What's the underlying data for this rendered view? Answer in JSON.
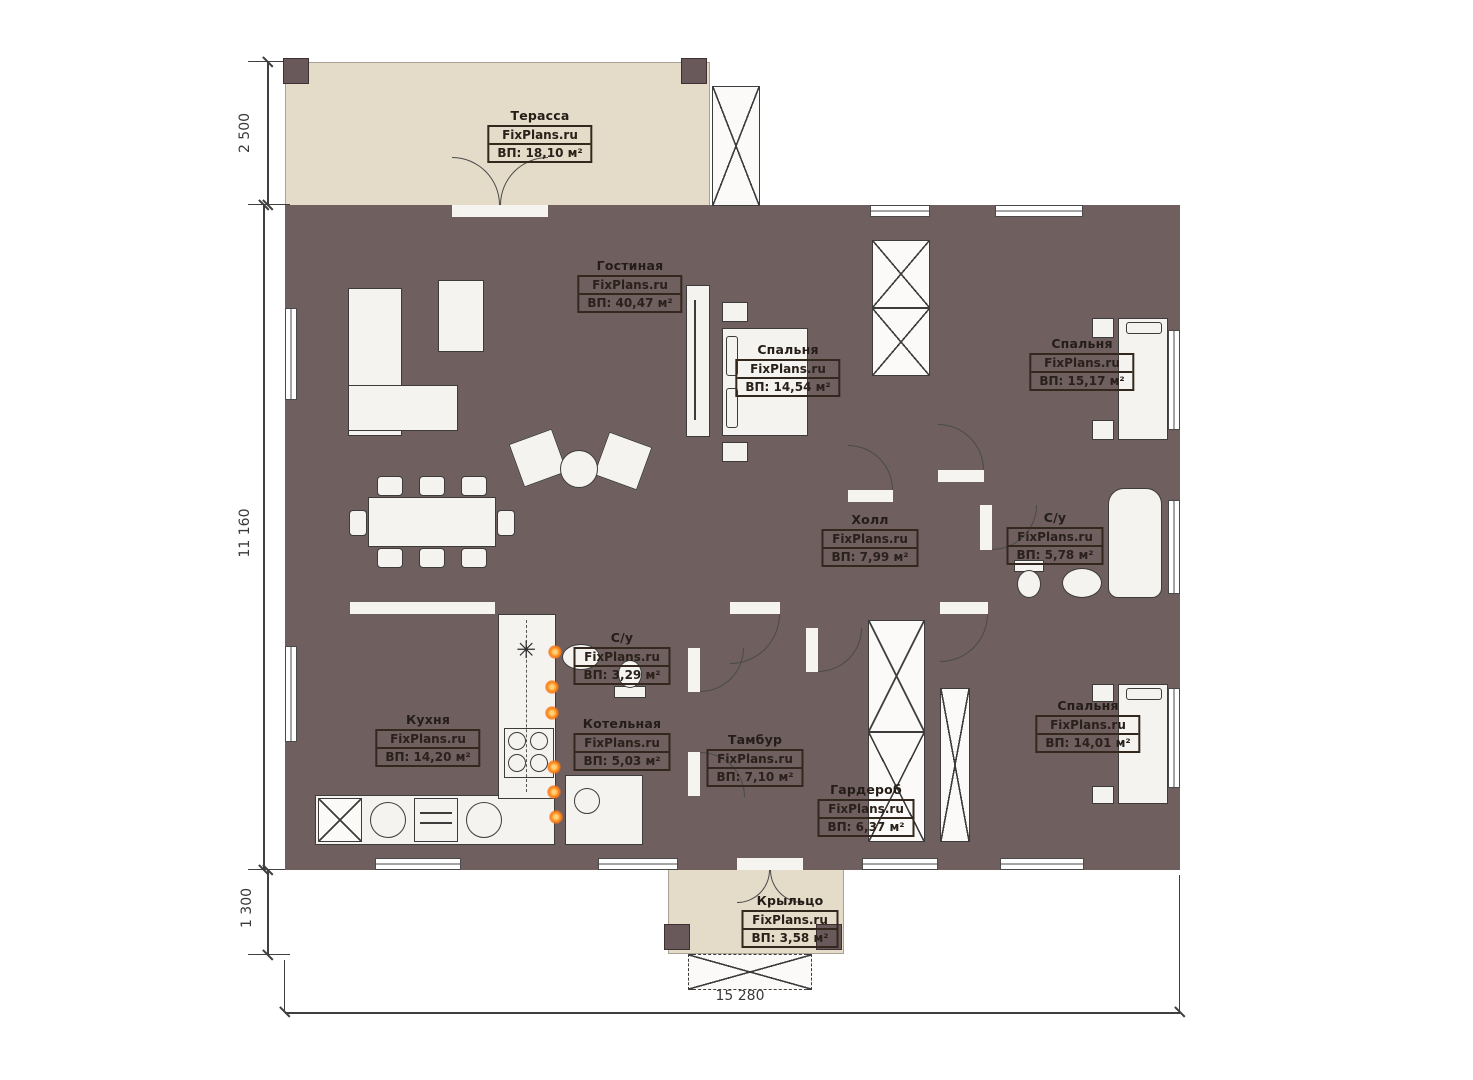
{
  "brand": "FixPlans.ru",
  "dimensions": {
    "terrace_depth": "2 500",
    "house_height": "11 160",
    "porch_depth": "1 300",
    "house_width": "15 280"
  },
  "icons": {
    "fridge_snowflake": "✳"
  },
  "rooms": [
    {
      "name": "Терасса",
      "area": "ВП: 18,10 м²"
    },
    {
      "name": "Гостиная",
      "area": "ВП: 40,47 м²"
    },
    {
      "name": "Спальня",
      "area": "ВП: 14,54 м²"
    },
    {
      "name": "Спальня",
      "area": "ВП: 15,17 м²"
    },
    {
      "name": "Холл",
      "area": "ВП: 7,99 м²"
    },
    {
      "name": "С/у",
      "area": "ВП: 5,78 м²"
    },
    {
      "name": "Кухня",
      "area": "ВП: 14,20 м²"
    },
    {
      "name": "С/у",
      "area": "ВП: 3,29 м²"
    },
    {
      "name": "Котельная",
      "area": "ВП: 5,03 м²"
    },
    {
      "name": "Тамбур",
      "area": "ВП: 7,10 м²"
    },
    {
      "name": "Гардероб",
      "area": "ВП: 6,37 м²"
    },
    {
      "name": "Спальня",
      "area": "ВП: 14,01 м²"
    },
    {
      "name": "Крыльцо",
      "area": "ВП: 3,58 м²"
    }
  ]
}
